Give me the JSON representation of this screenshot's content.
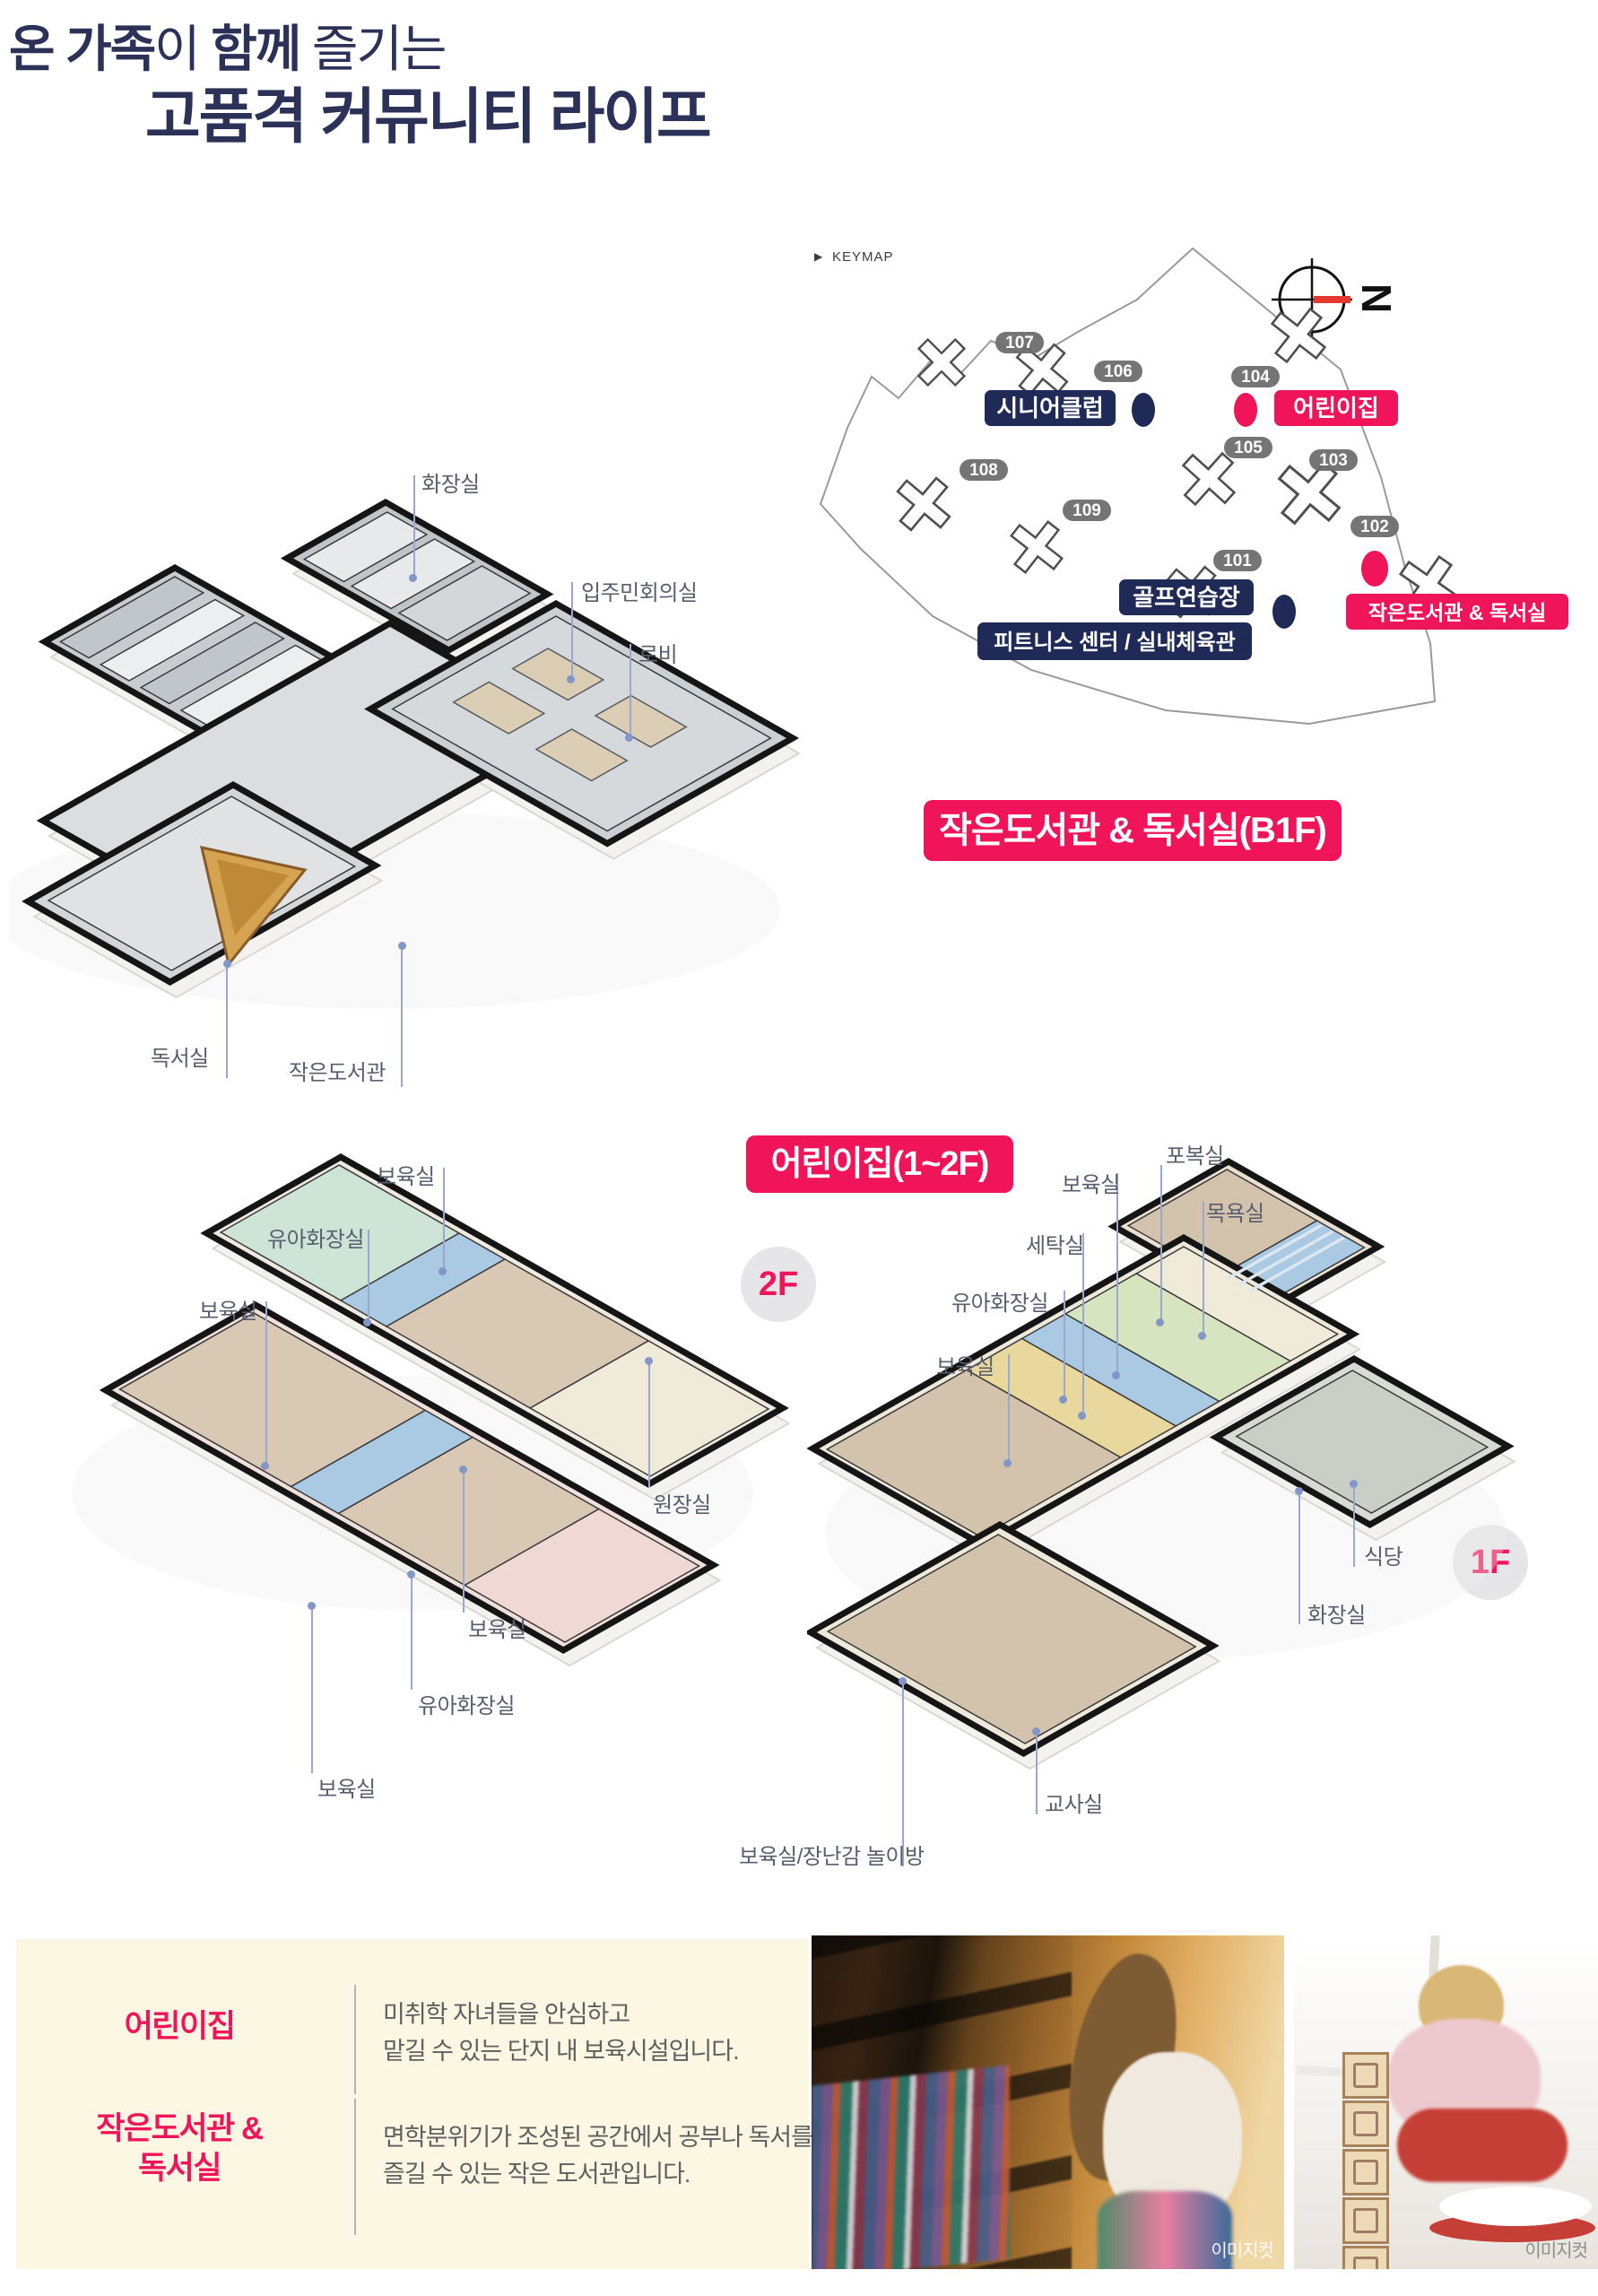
{
  "header": {
    "title_bold1": "온 가족",
    "title_reg1": "이 ",
    "title_bold2": "함께",
    "title_reg2": " 즐기는",
    "title_line2": "고품격 커뮤니티 라이프"
  },
  "keymap": {
    "arrow": "▶",
    "label": "KEYMAP",
    "north": "N",
    "buildings": [
      {
        "num": "101"
      },
      {
        "num": "102"
      },
      {
        "num": "103"
      },
      {
        "num": "104"
      },
      {
        "num": "105"
      },
      {
        "num": "106"
      },
      {
        "num": "107"
      },
      {
        "num": "108"
      },
      {
        "num": "109"
      }
    ],
    "facilities": [
      {
        "label": "시니어클럽",
        "type": "navy"
      },
      {
        "label": "어린이집",
        "type": "pink"
      },
      {
        "label": "골프연습장",
        "type": "navy"
      },
      {
        "label": "피트니스 센터 / 실내체육관",
        "type": "navy"
      },
      {
        "label": "작은도서관 & 독서실",
        "type": "pink"
      }
    ]
  },
  "library": {
    "title": "작은도서관 & 독서실(B1F)",
    "labels": [
      "화장실",
      "입주민회의실",
      "로비",
      "독서실",
      "작은도서관"
    ]
  },
  "daycare": {
    "title": "어린이집(1~2F)",
    "floor2_badge": "2F",
    "floor1_badge": "1F",
    "labels_2f": [
      "보육실",
      "유아화장실",
      "보육실",
      "원장실",
      "보육실",
      "유아화장실",
      "보육실"
    ],
    "labels_1f": [
      "포복실",
      "보육실",
      "목욕실",
      "세탁실",
      "유아화장실",
      "보육실",
      "식당",
      "화장실",
      "교사실",
      "보육실/장난감 놀이방"
    ]
  },
  "info": {
    "rows": [
      {
        "title": "어린이집",
        "title2": "",
        "desc1": "미취학 자녀들을 안심하고",
        "desc2": "맡길 수 있는 단지 내 보육시설입니다."
      },
      {
        "title": "작은도서관 &",
        "title2": "독서실",
        "desc1": "면학분위기가 조성된 공간에서 공부나 독서를",
        "desc2": "즐길 수 있는 작은 도서관입니다."
      }
    ]
  },
  "photos": {
    "caption": "이미지컷"
  },
  "colors": {
    "pink": "#F0145A",
    "navy": "#1F2A56",
    "headline": "#2B3157"
  }
}
